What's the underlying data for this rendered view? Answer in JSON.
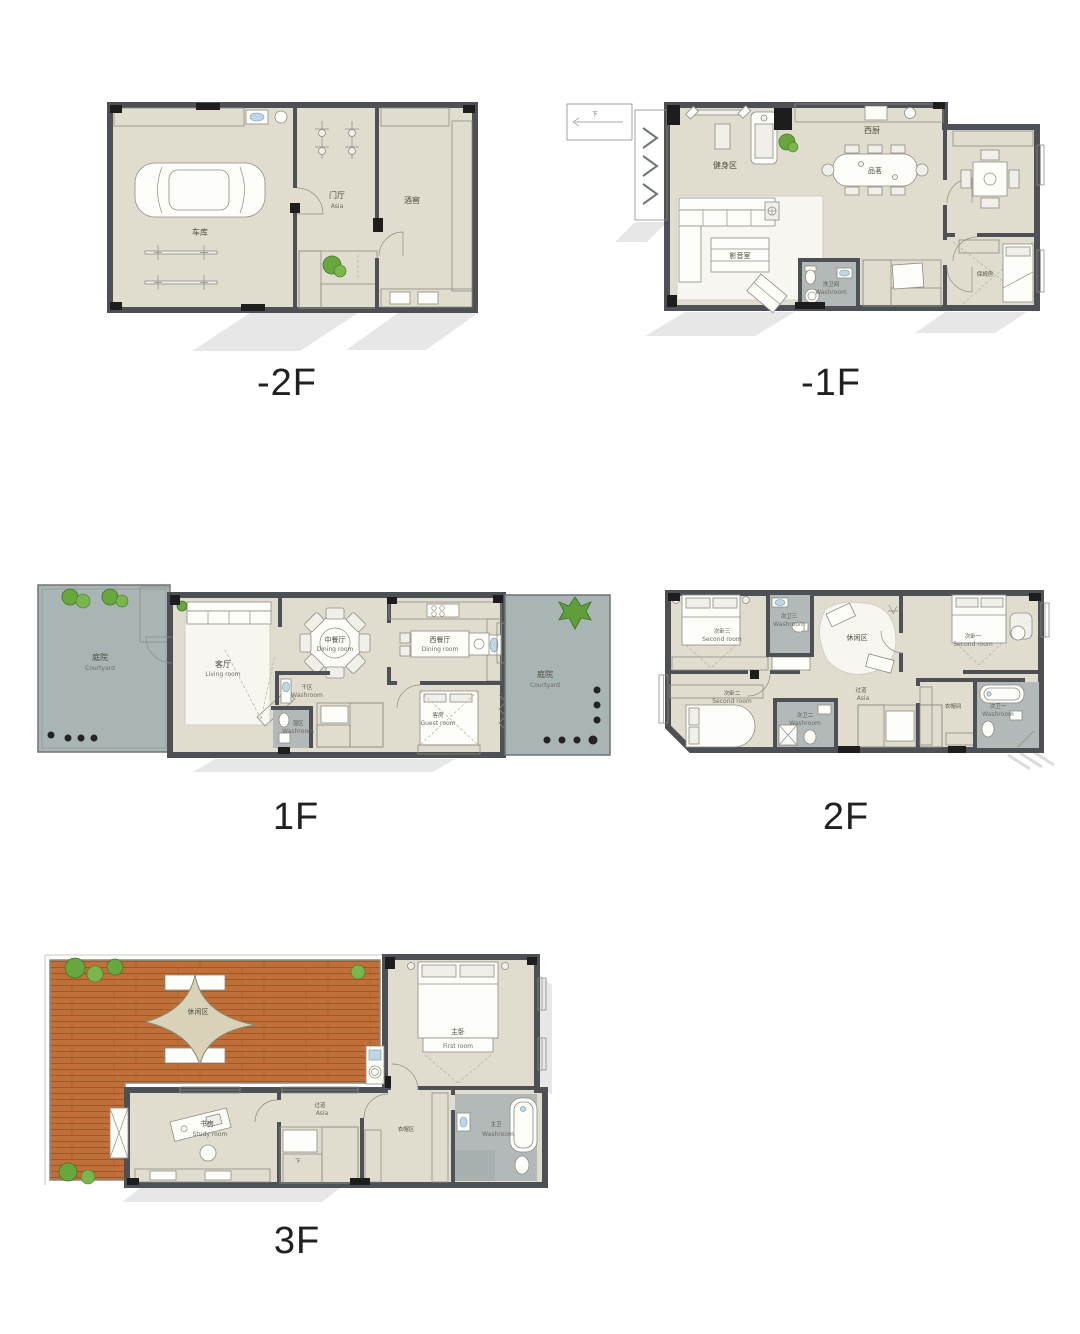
{
  "page": {
    "bg": "#ffffff"
  },
  "floors": {
    "m2": {
      "label": "-2F",
      "rooms": {
        "garage": {
          "cn": "车库"
        },
        "foyer": {
          "cn": "门厅",
          "en": "Asia"
        },
        "wine": {
          "cn": "酒窖"
        }
      }
    },
    "m1": {
      "label": "-1F",
      "stair_down": "下",
      "rooms": {
        "gym": {
          "cn": "健身区"
        },
        "kitchen": {
          "cn": "西厨"
        },
        "tea": {
          "cn": "品茗"
        },
        "av": {
          "cn": "影音室"
        },
        "wash": {
          "cn": "洗卫间",
          "en": "Washroom"
        },
        "nanny": {
          "cn": "保姆房"
        }
      }
    },
    "f1": {
      "label": "1F",
      "rooms": {
        "court_l": {
          "cn": "庭院",
          "en": "Courtyard"
        },
        "living": {
          "cn": "客厅",
          "en": "Living room"
        },
        "dining_cn": {
          "cn": "中餐厅",
          "en": "Dining room"
        },
        "dining_w": {
          "cn": "西餐厅",
          "en": "Dining room"
        },
        "dry": {
          "cn": "干区",
          "en": "Washroom"
        },
        "wet": {
          "cn": "湿区",
          "en": "Washroom"
        },
        "guest": {
          "cn": "客房",
          "en": "Guest room"
        },
        "court_r": {
          "cn": "庭院",
          "en": "Courtyard"
        }
      }
    },
    "f2": {
      "label": "2F",
      "rooms": {
        "bed3": {
          "cn": "次卧三",
          "en": "Second room"
        },
        "bath3": {
          "cn": "次卫三",
          "en": "Washroom"
        },
        "leisure": {
          "cn": "休闲区"
        },
        "bed1": {
          "cn": "次卧一",
          "en": "Second room"
        },
        "bed2": {
          "cn": "次卧二",
          "en": "Second room"
        },
        "bath2": {
          "cn": "次卫二",
          "en": "Washroom"
        },
        "hall": {
          "cn": "过道",
          "en": "Asia"
        },
        "cloak": {
          "cn": "衣帽间"
        },
        "bath1": {
          "cn": "次卫一",
          "en": "Washroom"
        }
      }
    },
    "f3": {
      "label": "3F",
      "stair_down": "下",
      "rooms": {
        "terrace": {
          "cn": "休闲区"
        },
        "master": {
          "cn": "主卧",
          "en": "First room"
        },
        "hall": {
          "cn": "过道",
          "en": "Asia"
        },
        "study": {
          "cn": "书房",
          "en": "Study room"
        },
        "cloak": {
          "cn": "衣帽区"
        },
        "mbath": {
          "cn": "主卫",
          "en": "Washroom"
        }
      }
    }
  }
}
